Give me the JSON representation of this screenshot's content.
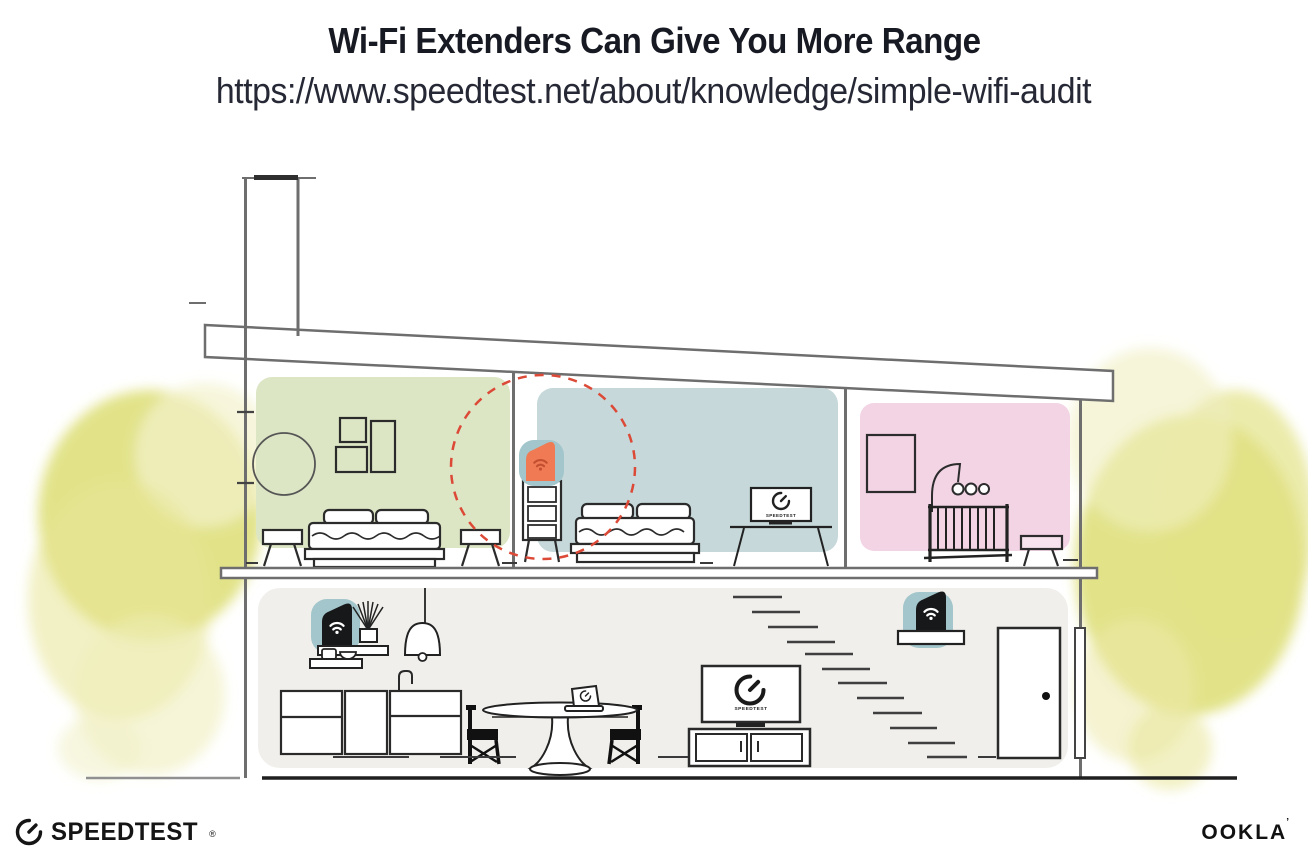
{
  "header": {
    "title": "Wi-Fi Extenders Can Give You More Range",
    "url": "https://www.speedtest.net/about/knowledge/simple-wifi-audit"
  },
  "footer": {
    "speedtest": "SPEEDTEST",
    "speedtest_reg": "®",
    "ookla": "OOKLA",
    "ookla_mark": "’"
  },
  "labels": {
    "living_tv": "SPEEDTEST",
    "bedroom_tv": "SPEEDTEST"
  },
  "icons": {
    "wifi-icon": "two arcs + dot",
    "gauge-icon": "speedometer circle with needle, gap at top-right"
  },
  "colors": {
    "ink": "#171923",
    "url_ink": "#262935",
    "line": "#6e6e6e",
    "furn": "#2b2b2b",
    "room_green": "#dce6c5",
    "room_blue": "#c6d8da",
    "room_pink": "#f2d4e5",
    "floor": "#f0efeb",
    "teal": "#a2c6cb",
    "orange": "#ef7a54",
    "wifi_orange": "#c24f30",
    "coverage": "#dc4a37",
    "tree": "#dfe07c",
    "tree_light": "#eeedb6",
    "device": "#17181a",
    "ground": "#1f1f1f"
  }
}
